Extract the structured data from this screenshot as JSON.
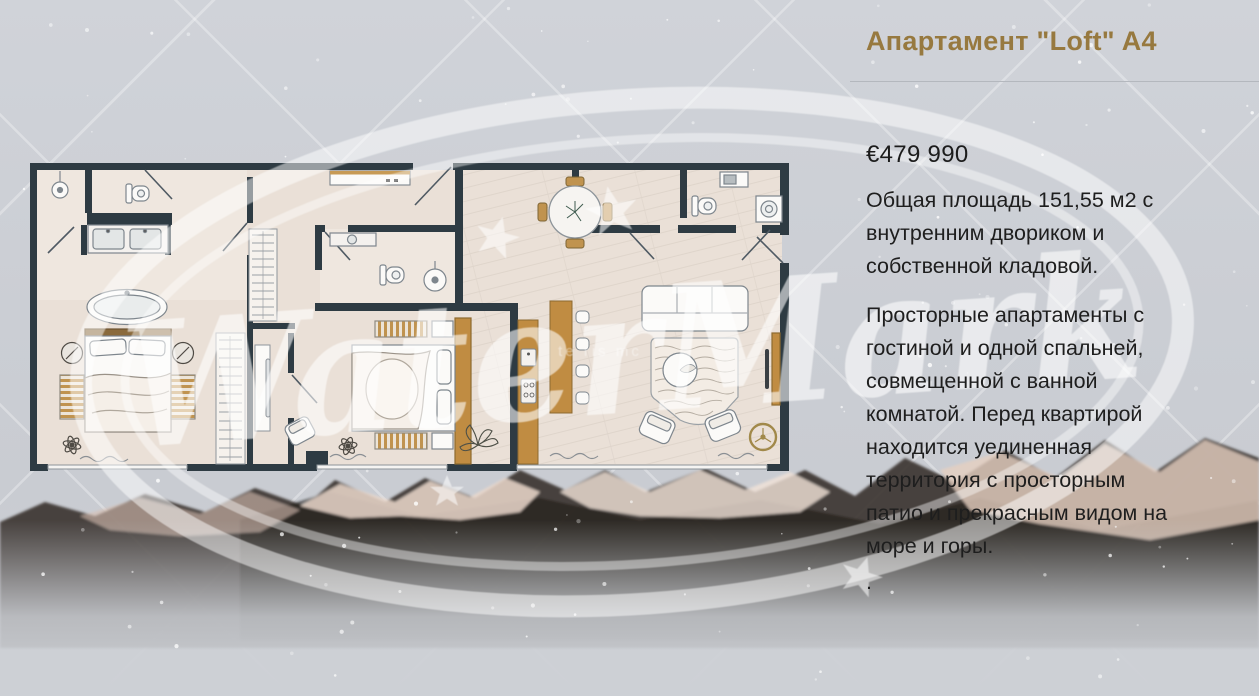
{
  "listing": {
    "title": "Апартамент \"Loft\" A4",
    "price": "€479 990",
    "area_paragraph": [
      "Общая площадь 151,55 м2 с",
      "внутренним двориком и",
      "собственной кладовой."
    ],
    "description_paragraph": [
      "Просторные апартаменты с",
      "гостиной и одной спальней,",
      "совмещенной с ванной",
      "комнатой. Перед квартирой",
      "находится уединенная",
      "территория с просторным",
      "патио и прекрасным видом на",
      "море и горы."
    ],
    "trailing_text": "."
  },
  "watermark": {
    "text": "WaterMark",
    "subtext": "te ris mc"
  },
  "colors": {
    "title_accent": "#97793F",
    "body_text": "#1E1E1E",
    "plan_wall": "#2E3B43",
    "plan_wood": "#C08C42",
    "plan_floor": "#EAE0D7",
    "watermark": "#FFFFFF",
    "fan_gold": "#A1894A"
  }
}
